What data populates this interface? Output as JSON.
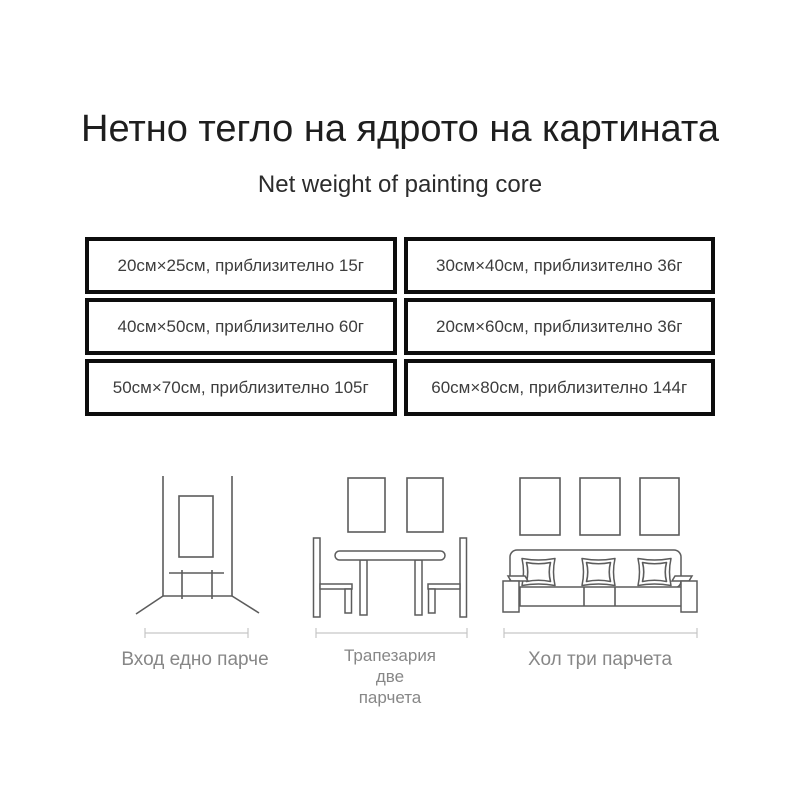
{
  "header": {
    "title": "Нетно тегло на ядрото на картината",
    "subtitle": "Net weight of painting core"
  },
  "weight_table": {
    "rows": [
      {
        "cells": [
          "20см×25см, приблизително 15г",
          "30см×40см, приблизително 36г"
        ]
      },
      {
        "cells": [
          "40см×50см, приблизително 60г",
          "20см×60см, приблизително 36г"
        ]
      },
      {
        "cells": [
          "50см×70см, приблизително 105г",
          "60см×80см, приблизително 144г"
        ]
      }
    ]
  },
  "figures": {
    "entrance": {
      "label": "Вход едно парче",
      "illustration": "entrance-hallway-one-painting"
    },
    "dining": {
      "label_lines": [
        "Трапезария",
        "две",
        "парчета"
      ],
      "illustration": "dining-table-two-paintings"
    },
    "living": {
      "label": "Хол три парчета",
      "illustration": "sofa-three-paintings"
    }
  },
  "colors": {
    "background": "#ffffff",
    "title_text": "#1e1e1e",
    "subtitle_text": "#2c2c2c",
    "table_border": "#0d0d0d",
    "table_text": "#3d3d3d",
    "sketch_stroke": "#5c5c5c",
    "dimension_line": "#c6c6c6",
    "label_text": "#878787"
  }
}
